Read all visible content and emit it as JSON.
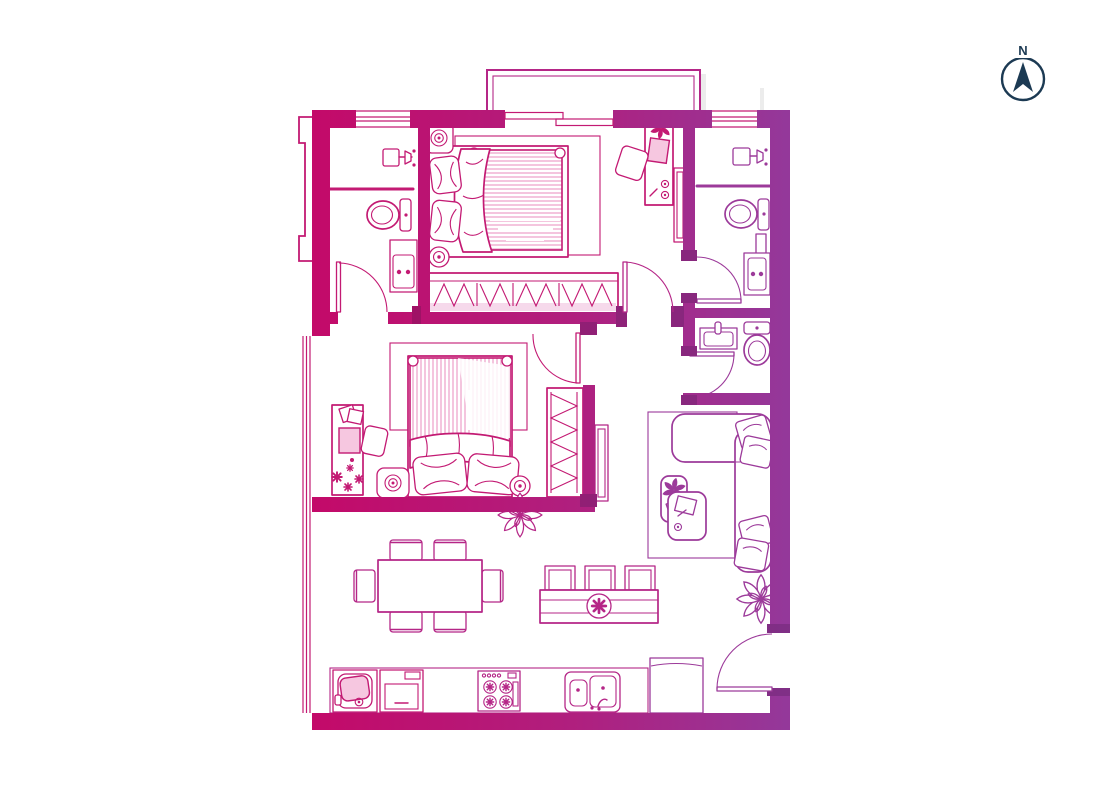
{
  "compass": {
    "north_label": "N"
  },
  "colors": {
    "background": "#FFFFFF",
    "wall_magenta": "#C40968",
    "wall_mid": "#B01F7E",
    "wall_purple": "#93399B",
    "wall_dark_magenta": "#A9085C",
    "wall_dark_purple": "#7F3087",
    "line_magenta": "#C31A73",
    "line_mid": "#B52687",
    "line_purple": "#9C3A9A",
    "stripe_pink": "#F0B2D4",
    "fill_pink": "#F6C7E0",
    "band_pink": "#F6D9EB",
    "shadow_gray": "#DCDCDC",
    "compass_navy": "#1C3A53"
  },
  "floor_plan": {
    "type": "apartment-2-bedroom",
    "balcony": {
      "position": "top",
      "access": "sliding-glass-door"
    },
    "windows": [
      "top-wall-left",
      "top-wall-sliding-door",
      "top-wall-right",
      "left-wall-long"
    ],
    "rooms": [
      {
        "id": "bathroom-left",
        "fixtures": [
          "shower-head",
          "glass-partition",
          "toilet",
          "vanity-sink",
          "door-swing"
        ]
      },
      {
        "id": "master-bedroom",
        "furniture": [
          "double-bed-horizontal",
          "striped-duvet",
          "pillow",
          "pillow",
          "folded-blanket",
          "rug",
          "bedside-lamp",
          "bedside-lamp",
          "wardrobe-hangers",
          "desk",
          "monitor",
          "desk-chair",
          "tv-panel",
          "small-plant",
          "door-swing"
        ]
      },
      {
        "id": "ensuite-bathroom-right",
        "fixtures": [
          "shower-head",
          "glass-partition",
          "toilet",
          "towel-radiator",
          "vanity-sink",
          "door-swing"
        ]
      },
      {
        "id": "powder-room",
        "fixtures": [
          "wash-basin",
          "toilet-vertical",
          "door-swing"
        ]
      },
      {
        "id": "bedroom-2",
        "furniture": [
          "double-bed-vertical",
          "striped-duvet",
          "pillow",
          "pillow",
          "folded-blanket",
          "rug",
          "desk",
          "laptop",
          "papers",
          "desk-chair",
          "bedside-lamp",
          "bedside-lamp",
          "wardrobe-hangers",
          "decor-stars",
          "door-swing"
        ]
      },
      {
        "id": "corridor",
        "furniture": [
          "tv-panel"
        ]
      },
      {
        "id": "living-room",
        "furniture": [
          "l-shaped-sofa",
          "cushion",
          "cushion",
          "cushion",
          "cushion",
          "rug",
          "coffee-table-with-plant",
          "coffee-table-with-tray",
          "plant-large"
        ]
      },
      {
        "id": "dining-area",
        "furniture": [
          "dining-table",
          "chair-top-1",
          "chair-top-2",
          "chair-bottom-1",
          "chair-bottom-2",
          "chair-left",
          "chair-right",
          "plant-large"
        ]
      },
      {
        "id": "media-console",
        "furniture": [
          "sideboard",
          "stool",
          "stool",
          "stool",
          "medallion"
        ]
      },
      {
        "id": "kitchen",
        "appliances": [
          "counter",
          "washing-machine",
          "oven",
          "stove-4-burner",
          "double-sink-with-faucet",
          "fridge"
        ]
      },
      {
        "id": "entry",
        "fixtures": [
          "entry-door-swing",
          "plant-large"
        ]
      }
    ]
  }
}
